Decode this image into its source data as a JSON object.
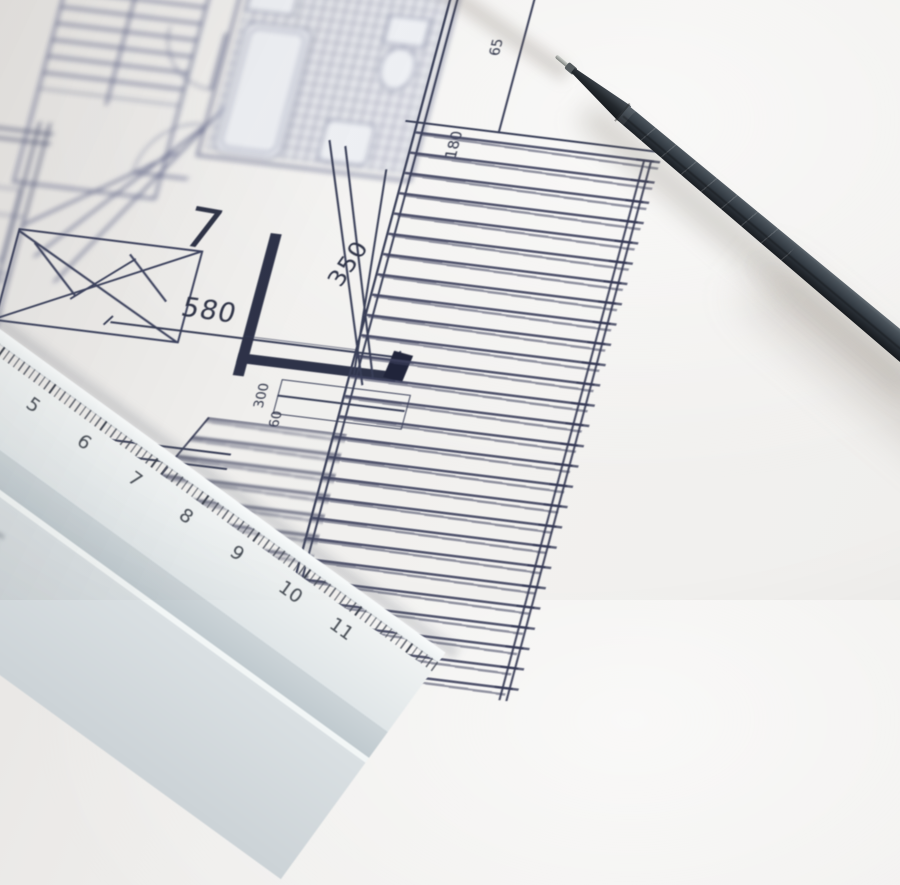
{
  "paper": {
    "color": "#efeeec"
  },
  "plan": {
    "ink_color": "#383e57",
    "room_number": "7",
    "dimensions": {
      "room_width": "580",
      "window_height": "350",
      "door_width": "300",
      "door_offset": "60",
      "terrace_depth": "180",
      "terrace_offset": "65"
    }
  },
  "ruler": {
    "numbers": [
      "4",
      "5",
      "6",
      "7",
      "8",
      "9",
      "10",
      "11"
    ],
    "corner_number": "3",
    "color": "#e9edee"
  },
  "pencil": {
    "color": "#2c3339"
  }
}
